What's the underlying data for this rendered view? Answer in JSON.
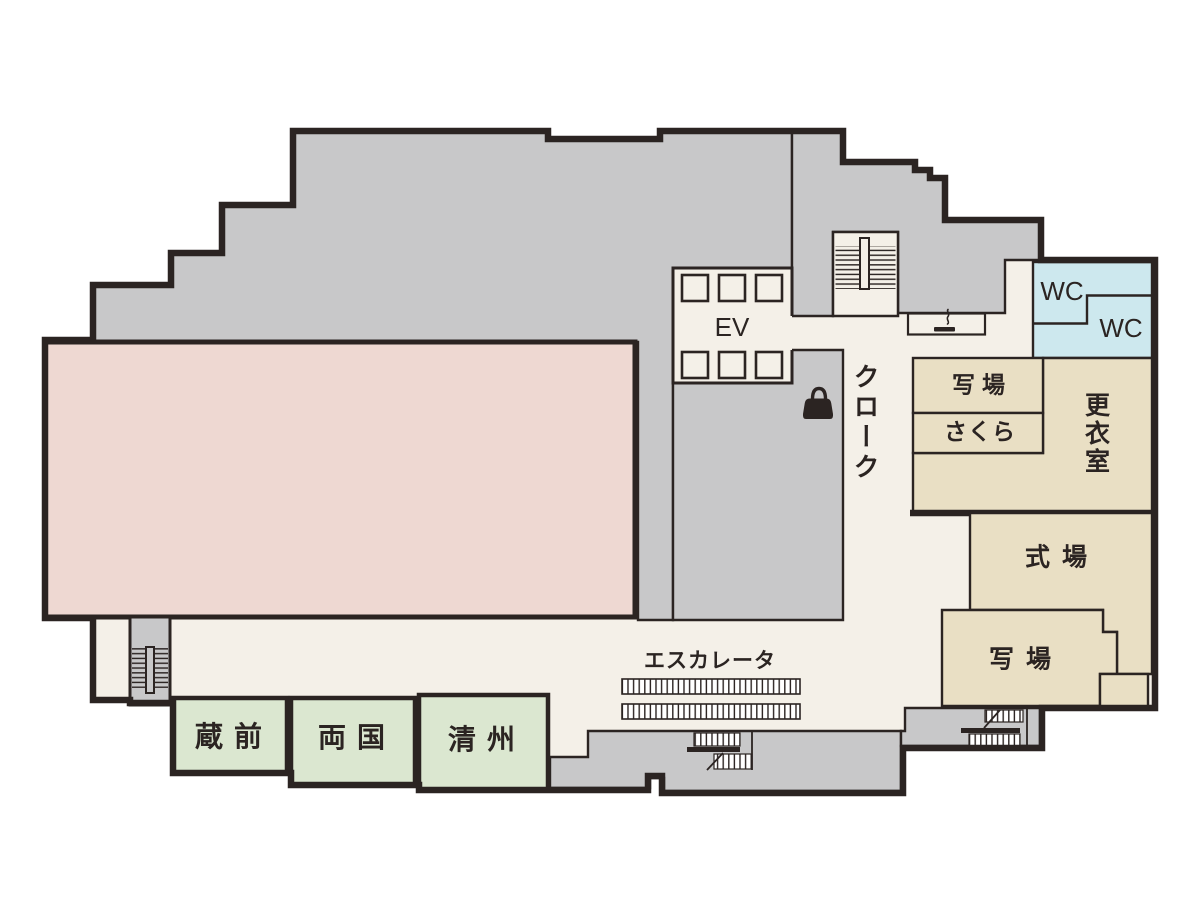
{
  "colors": {
    "wall": "#2b2422",
    "gray": "#c8c8c9",
    "cream": "#f4f0e8",
    "pink": "#eed8d2",
    "blue": "#cde8ee",
    "beige": "#e9dfc4",
    "green": "#dbe7d0",
    "page": "#ffffff"
  },
  "rooms": {
    "kuramae": "蔵前",
    "ryogoku": "両国",
    "kiyosu": "清州",
    "shajou_upper": "写場",
    "sakura": "さくら",
    "changing_room": "更衣室",
    "ceremony_hall": "式場",
    "shajou_lower": "写場",
    "wc_upper": "WC",
    "wc_lower": "WC"
  },
  "labels": {
    "elevator": "EV",
    "cloak": "クローク",
    "escalator": "エスカレータ"
  },
  "icons": {
    "bag": "bag-icon",
    "smoking": "smoking-icon",
    "stairs": "stairs-icon",
    "escalator_strip": "escalator-strip",
    "elevator_car": "elevator-car"
  }
}
